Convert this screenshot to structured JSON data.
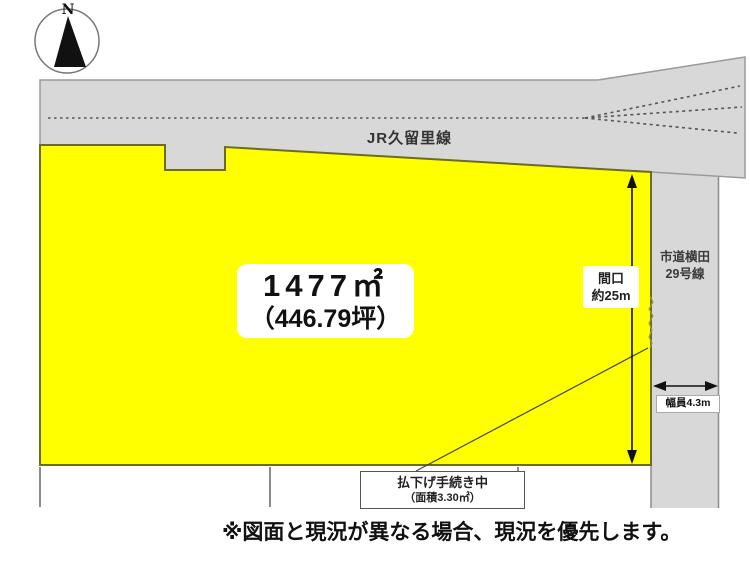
{
  "colors": {
    "parcel_fill": "#ffff00",
    "parcel_stroke": "#6b6b22",
    "land_fill": "#d8d8d8",
    "land_stroke": "#9a9a9a",
    "ink": "#111111"
  },
  "compass": {
    "north_label": "N"
  },
  "railway": {
    "name": "JR久留里線"
  },
  "parcel": {
    "area_sqm": "1477㎡",
    "area_tsubo": "（446.79坪）"
  },
  "frontage": {
    "title": "間口",
    "value": "約25m"
  },
  "road": {
    "name_line1": "市道横田",
    "name_line2": "29号線",
    "width_value": "幅員4.3m"
  },
  "procedure": {
    "status": "払下げ手続き中",
    "area": "（面積3.30㎡）"
  },
  "footnote": "※図面と現況が異なる場合、現況を優先します。"
}
